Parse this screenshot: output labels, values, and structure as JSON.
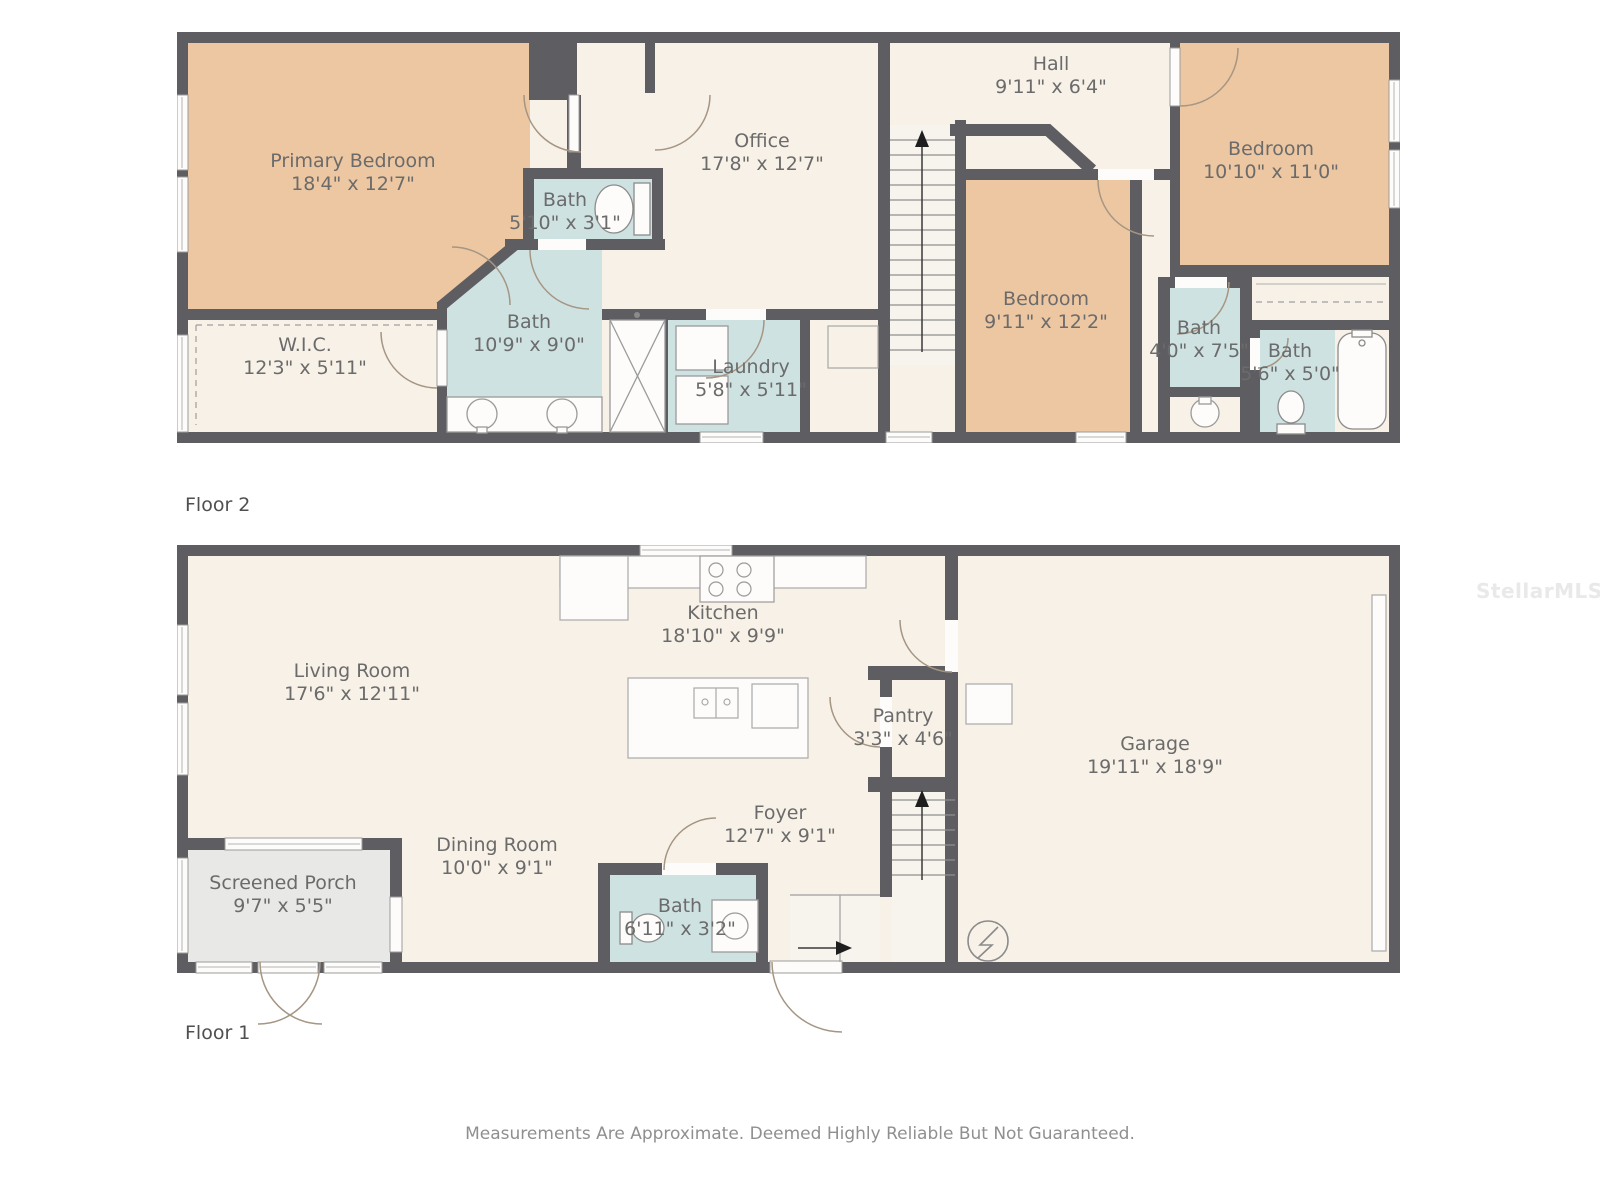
{
  "watermark": {
    "text": "StellarMLS"
  },
  "footer": {
    "disclaimer": "Measurements Are Approximate. Deemed Highly Reliable But Not Guaranteed."
  },
  "colors": {
    "wall": "#5e5e62",
    "room": "#f8f1e7",
    "bedroom": "#ecc7a2",
    "bath": "#cfe2e2",
    "porch": "#e8e8e6",
    "stairs": "#f7f4ee",
    "label_text": "#6b6b6b"
  },
  "floor2": {
    "label": "Floor 2",
    "rooms": {
      "primary_bedroom": {
        "name": "Primary Bedroom",
        "dims": "18'4\" x 12'7\""
      },
      "wic": {
        "name": "W.I.C.",
        "dims": "12'3\" x 5'11\""
      },
      "bath_ensuite": {
        "name": "Bath",
        "dims": "5'10\" x 3'1\""
      },
      "bath_main": {
        "name": "Bath",
        "dims": "10'9\" x 9'0\""
      },
      "office": {
        "name": "Office",
        "dims": "17'8\" x 12'7\""
      },
      "laundry": {
        "name": "Laundry",
        "dims": "5'8\" x 5'11\""
      },
      "hall": {
        "name": "Hall",
        "dims": "9'11\" x 6'4\""
      },
      "bedroom_middle": {
        "name": "Bedroom",
        "dims": "9'11\" x 12'2\""
      },
      "bedroom_right": {
        "name": "Bedroom",
        "dims": "10'10\" x 11'0\""
      },
      "bath_hall": {
        "name": "Bath",
        "dims": "4'0\" x 7'5\""
      },
      "bath_tub": {
        "name": "Bath",
        "dims": "5'6\" x 5'0\""
      }
    }
  },
  "floor1": {
    "label": "Floor 1",
    "rooms": {
      "living_room": {
        "name": "Living Room",
        "dims": "17'6\" x 12'11\""
      },
      "kitchen": {
        "name": "Kitchen",
        "dims": "18'10\" x 9'9\""
      },
      "pantry": {
        "name": "Pantry",
        "dims": "3'3\" x 4'6\""
      },
      "foyer": {
        "name": "Foyer",
        "dims": "12'7\" x 9'1\""
      },
      "dining_room": {
        "name": "Dining Room",
        "dims": "10'0\" x 9'1\""
      },
      "screened_porch": {
        "name": "Screened Porch",
        "dims": "9'7\" x 5'5\""
      },
      "bath": {
        "name": "Bath",
        "dims": "6'11\" x 3'2\""
      },
      "garage": {
        "name": "Garage",
        "dims": "19'11\" x 18'9\""
      }
    }
  }
}
